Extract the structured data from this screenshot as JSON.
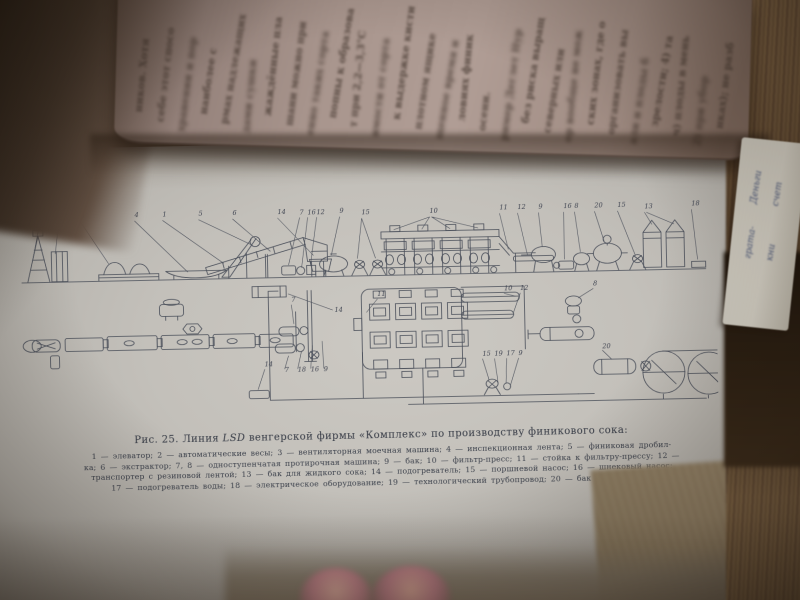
{
  "figure": {
    "caption_prefix": "Рис. 25. Линия ",
    "caption_lsd": "LSD",
    "caption_suffix": " венгерской фирмы «Комплекс» по производству финикового сока:",
    "legend_lines": [
      "1 — элеватор; 2 — автоматические весы; 3 — вентиляторная моечная машина; 4 — инспекционная лента; 5 — финиковая дробил-",
      "ка; 6 — экстрактор; 7, 8 — одноступенчатая протирочная машина; 9 — бак; 10 — фильтр-пресс; 11 — стойка к фильтру-прессу; 12 —",
      "транспортер с резиновой лентой; 13 — бак для жидкого сока; 14 — подогреватель; 15 — поршневой насос; 16 — шнековый насос;",
      "17 — подогреватель воды; 18 — электрическое оборудование; 19 — технологический трубопровод; 20 — бак с мешалками"
    ],
    "elevation_labels": [
      "1",
      "2",
      "3",
      "4",
      "1",
      "5",
      "6",
      "14",
      "7",
      "16",
      "12",
      "9",
      "15",
      "10",
      "11",
      "12",
      "9",
      "16",
      "8",
      "20",
      "15",
      "13",
      "18"
    ],
    "plan_labels": [
      "7",
      "14",
      "11",
      "10",
      "12",
      "8",
      "14",
      "7",
      "18",
      "16",
      "9",
      "15",
      "19",
      "17",
      "9",
      "20"
    ]
  },
  "left_page_fragments": [
    "ников. Хотя",
    "себе этот спосо",
    "хранении и пор",
    "наиболее с",
    "рмах надлежащих",
    "дами сушки",
    "жаждённые пла",
    "шани можно при",
    "енно таких сорта",
    "попны к образова",
    "т при 2,2—3,3°С",
    "имости от сорта",
    "к выдержке кисти",
    "плотном ящике",
    "щенное время и",
    "ловиях финик",
    "осени.",
    "ример Деглет Нур",
    "без риска выращ",
    "северных или",
    "ор вообще не мож",
    "ских зонах, где о",
    "организовать вы",
    "али и плоды б",
    "зрелости; 4) та",
    "ч) плоды в мень",
    "2) при убор",
    "нках); не разб"
  ],
  "bookmark_fragments": [
    "грата-",
    "кни",
    "Деньги",
    "счет"
  ],
  "colors": {
    "page": "#c3c0ba",
    "diagram_ink": "#4a4f5a",
    "caption_ink": "#3b404b",
    "table": "#8f8168",
    "fore_edge": "#8f7250",
    "bookmark_ink": "#47557a",
    "finger": "#c2838c"
  }
}
